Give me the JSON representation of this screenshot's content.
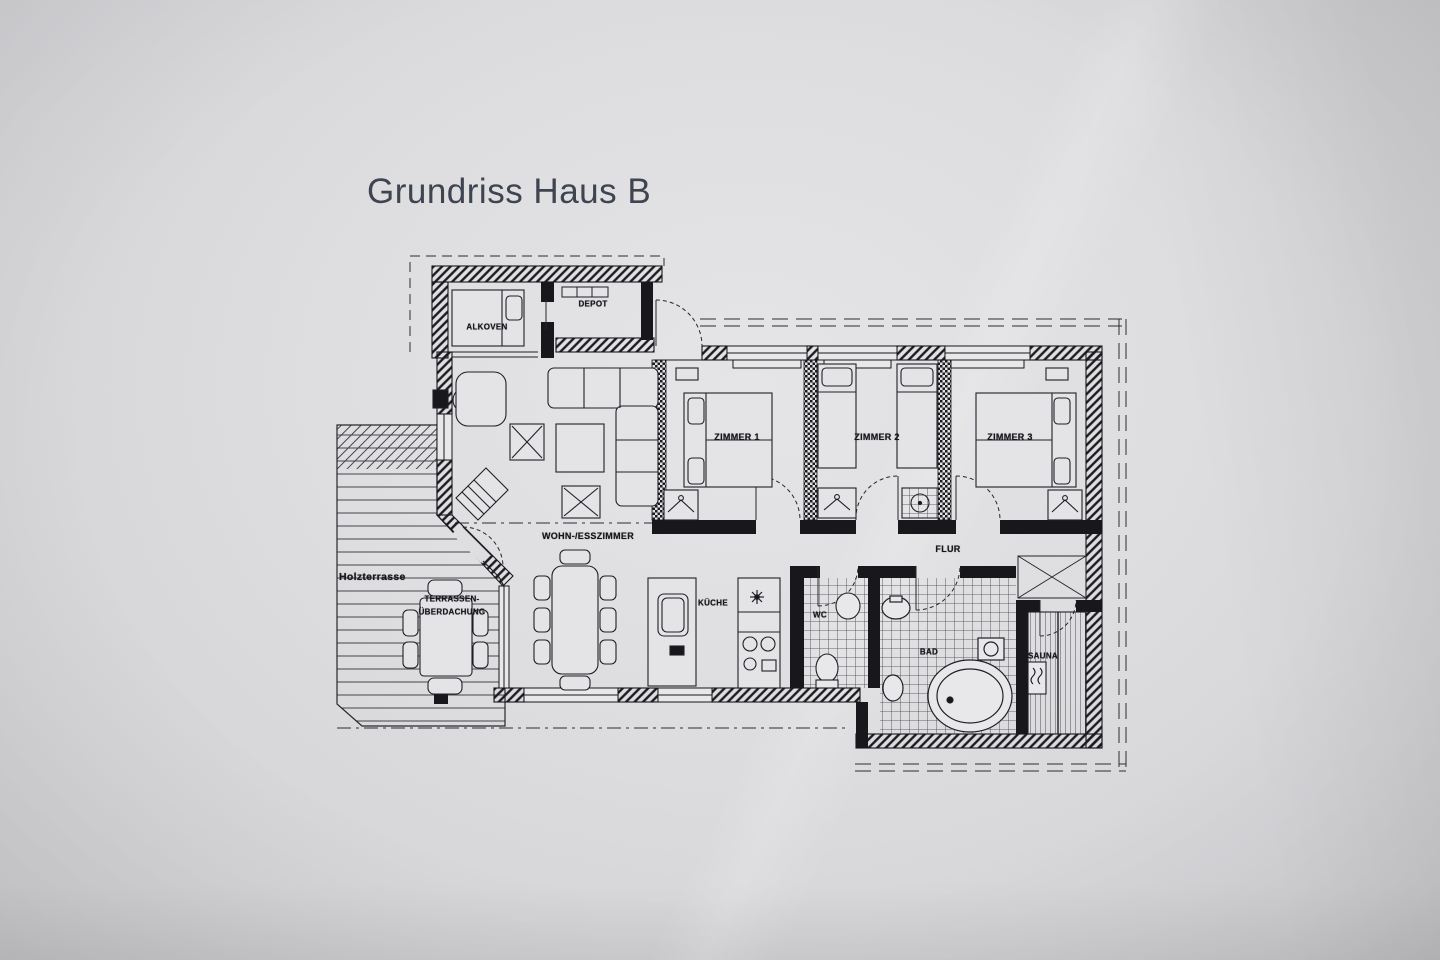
{
  "title": "Grundriss Haus B",
  "labels": {
    "alkoven": "ALKOVEN",
    "depot": "DEPOT",
    "zimmer1": "ZIMMER 1",
    "zimmer2": "ZIMMER 2",
    "zimmer3": "ZIMMER 3",
    "wohnesszimmer": "WOHN-/ESSZIMMER",
    "flur": "FLUR",
    "kueche": "KÜCHE",
    "wc": "WC",
    "bad": "BAD",
    "sauna": "SAUNA",
    "holzterrasse": "Holzterrasse",
    "terrasse_line1": "TERRASSEN-",
    "terrasse_line2": "ÜBERDACHUNG"
  },
  "colors": {
    "ink": "#17171c",
    "paper": "#dedee0",
    "title_text": "#3e4450"
  }
}
